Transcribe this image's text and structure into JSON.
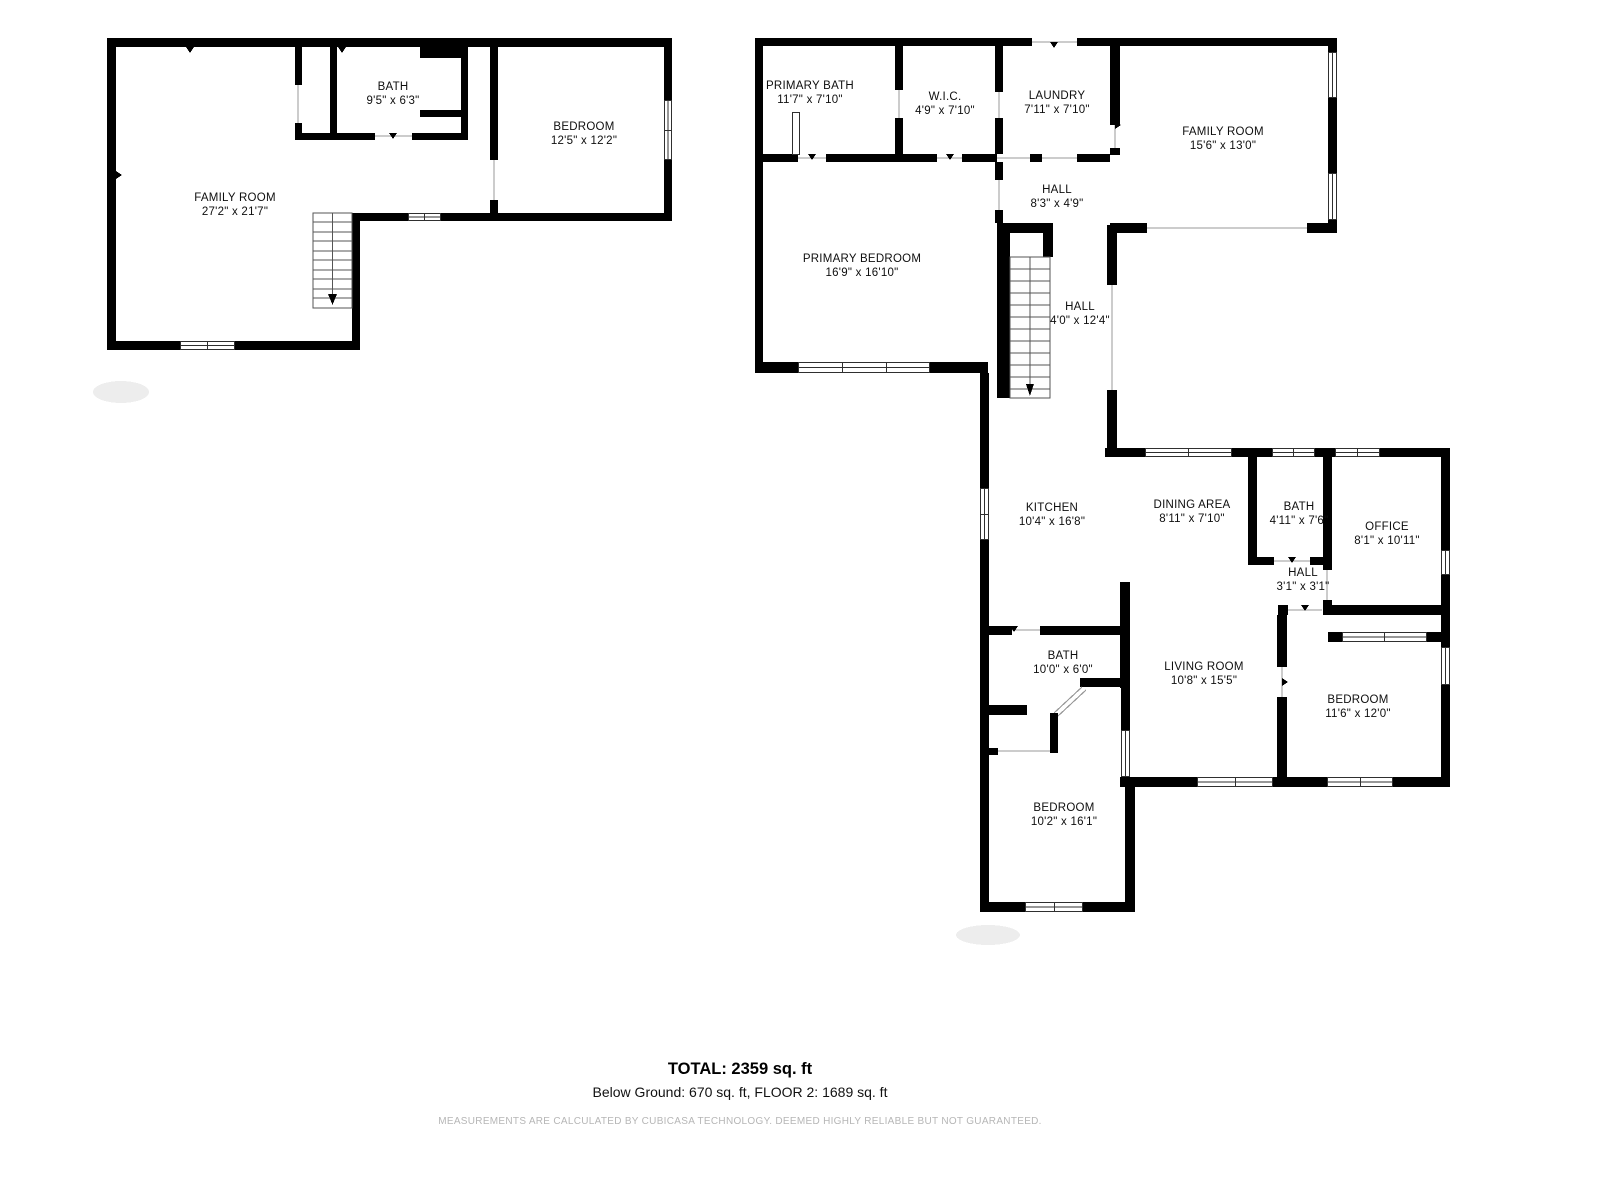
{
  "floors": [
    {
      "name": "Below Ground",
      "rooms": [
        {
          "name": "BATH",
          "dims": "9'5\" x 6'3\""
        },
        {
          "name": "BEDROOM",
          "dims": "12'5\" x 12'2\""
        },
        {
          "name": "FAMILY ROOM",
          "dims": "27'2\" x 21'7\""
        }
      ]
    },
    {
      "name": "Floor 2",
      "rooms": [
        {
          "name": "PRIMARY BATH",
          "dims": "11'7\" x 7'10\""
        },
        {
          "name": "W.I.C.",
          "dims": "4'9\" x 7'10\""
        },
        {
          "name": "LAUNDRY",
          "dims": "7'11\" x 7'10\""
        },
        {
          "name": "FAMILY ROOM",
          "dims": "15'6\" x 13'0\""
        },
        {
          "name": "HALL",
          "dims": "8'3\" x 4'9\""
        },
        {
          "name": "PRIMARY BEDROOM",
          "dims": "16'9\" x 16'10\""
        },
        {
          "name": "HALL",
          "dims": "4'0\" x 12'4\""
        },
        {
          "name": "KITCHEN",
          "dims": "10'4\" x 16'8\""
        },
        {
          "name": "DINING AREA",
          "dims": "8'11\" x 7'10\""
        },
        {
          "name": "BATH",
          "dims": "4'11\" x 7'6\""
        },
        {
          "name": "OFFICE",
          "dims": "8'1\" x 10'11\""
        },
        {
          "name": "HALL",
          "dims": "3'1\" x 3'1\""
        },
        {
          "name": "BATH",
          "dims": "10'0\" x 6'0\""
        },
        {
          "name": "LIVING ROOM",
          "dims": "10'8\" x 15'5\""
        },
        {
          "name": "BEDROOM",
          "dims": "11'6\" x 12'0\""
        },
        {
          "name": "BEDROOM",
          "dims": "10'2\" x 16'1\""
        }
      ]
    }
  ],
  "footer": {
    "total": "TOTAL: 2359 sq. ft",
    "breakdown": "Below Ground: 670 sq. ft, FLOOR 2: 1689 sq. ft",
    "disclaimer": "MEASUREMENTS ARE CALCULATED BY CUBICASA TECHNOLOGY. DEEMED HIGHLY RELIABLE BUT NOT GUARANTEED."
  },
  "colors": {
    "wall": "#000000",
    "window_line": "#2f2f2f",
    "opening_line": "#9a9a9a",
    "stair_line": "#555555",
    "watermark": "#ededed",
    "disclaimer_text": "#b6b6b6"
  }
}
